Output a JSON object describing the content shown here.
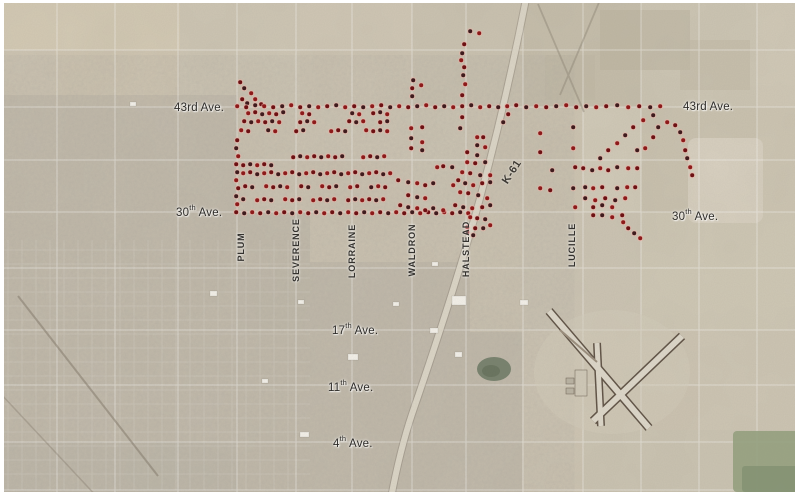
{
  "map_labels": {
    "avenues": [
      {
        "id": "43rd-left",
        "num": "43rd",
        "sup": "",
        "tail": " Ave."
      },
      {
        "id": "30th-left",
        "num": "30",
        "sup": "th",
        "tail": " Ave."
      },
      {
        "id": "43rd-right",
        "num": "43rd",
        "sup": "",
        "tail": " Ave."
      },
      {
        "id": "30th-right",
        "num": "30",
        "sup": "th",
        "tail": " Ave."
      },
      {
        "id": "17th",
        "num": "17",
        "sup": "th",
        "tail": " Ave."
      },
      {
        "id": "11th",
        "num": "11",
        "sup": "th",
        "tail": " Ave."
      },
      {
        "id": "4th",
        "num": "4",
        "sup": "th",
        "tail": " Ave."
      }
    ],
    "streets": [
      {
        "name": "PLUM"
      },
      {
        "name": "SEVERENCE"
      },
      {
        "name": "LORRAINE"
      },
      {
        "name": "WALDRON"
      },
      {
        "name": "HALSTEAD"
      },
      {
        "name": "LUCILLE"
      }
    ],
    "highway": {
      "name": "K-61"
    }
  },
  "dot_style": {
    "colors": [
      "#6d1113",
      "#3f1b1d",
      "#8d1a1a"
    ],
    "halo": "rgba(236,176,166,0.55)"
  },
  "dots": [
    [
      240,
      82
    ],
    [
      244,
      88
    ],
    [
      251,
      93
    ],
    [
      242,
      99
    ],
    [
      247,
      103
    ],
    [
      255,
      99
    ],
    [
      261,
      104
    ],
    [
      470,
      31
    ],
    [
      479,
      33
    ],
    [
      464,
      44
    ],
    [
      462,
      53
    ],
    [
      461,
      60
    ],
    [
      464,
      67
    ],
    [
      463,
      75
    ],
    [
      465,
      84
    ],
    [
      462,
      95
    ],
    [
      413,
      80
    ],
    [
      421,
      85
    ],
    [
      412,
      88
    ],
    [
      412,
      96
    ],
    [
      237,
      106
    ],
    [
      246,
      107
    ],
    [
      255,
      105
    ],
    [
      264,
      106
    ],
    [
      273,
      107
    ],
    [
      282,
      106
    ],
    [
      291,
      105
    ],
    [
      300,
      107
    ],
    [
      309,
      106
    ],
    [
      318,
      107
    ],
    [
      327,
      106
    ],
    [
      336,
      105
    ],
    [
      345,
      107
    ],
    [
      354,
      106
    ],
    [
      363,
      107
    ],
    [
      372,
      106
    ],
    [
      381,
      105
    ],
    [
      390,
      107
    ],
    [
      399,
      106
    ],
    [
      408,
      107
    ],
    [
      417,
      106
    ],
    [
      426,
      105
    ],
    [
      435,
      107
    ],
    [
      444,
      106
    ],
    [
      453,
      107
    ],
    [
      462,
      106
    ],
    [
      471,
      105
    ],
    [
      480,
      107
    ],
    [
      489,
      106
    ],
    [
      498,
      107
    ],
    [
      507,
      106
    ],
    [
      516,
      105
    ],
    [
      526,
      107
    ],
    [
      536,
      106
    ],
    [
      546,
      107
    ],
    [
      556,
      106
    ],
    [
      566,
      105
    ],
    [
      576,
      107
    ],
    [
      586,
      106
    ],
    [
      596,
      107
    ],
    [
      606,
      106
    ],
    [
      617,
      105
    ],
    [
      628,
      107
    ],
    [
      639,
      106
    ],
    [
      650,
      107
    ],
    [
      660,
      106
    ],
    [
      508,
      114
    ],
    [
      503,
      122
    ],
    [
      248,
      113
    ],
    [
      255,
      112
    ],
    [
      262,
      114
    ],
    [
      269,
      113
    ],
    [
      276,
      114
    ],
    [
      283,
      112
    ],
    [
      302,
      113
    ],
    [
      309,
      114
    ],
    [
      352,
      113
    ],
    [
      359,
      114
    ],
    [
      373,
      113
    ],
    [
      380,
      112
    ],
    [
      387,
      114
    ],
    [
      244,
      121
    ],
    [
      251,
      122
    ],
    [
      258,
      121
    ],
    [
      265,
      122
    ],
    [
      272,
      121
    ],
    [
      279,
      122
    ],
    [
      300,
      122
    ],
    [
      307,
      121
    ],
    [
      314,
      122
    ],
    [
      349,
      121
    ],
    [
      356,
      122
    ],
    [
      363,
      121
    ],
    [
      380,
      122
    ],
    [
      387,
      121
    ],
    [
      241,
      130
    ],
    [
      248,
      131
    ],
    [
      268,
      130
    ],
    [
      275,
      131
    ],
    [
      296,
      131
    ],
    [
      303,
      130
    ],
    [
      331,
      131
    ],
    [
      338,
      130
    ],
    [
      345,
      131
    ],
    [
      366,
      130
    ],
    [
      373,
      131
    ],
    [
      380,
      130
    ],
    [
      387,
      131
    ],
    [
      237,
      140
    ],
    [
      236,
      148
    ],
    [
      238,
      156
    ],
    [
      236,
      164
    ],
    [
      237,
      172
    ],
    [
      236,
      180
    ],
    [
      238,
      188
    ],
    [
      236,
      196
    ],
    [
      237,
      204
    ],
    [
      293,
      157
    ],
    [
      300,
      156
    ],
    [
      307,
      157
    ],
    [
      314,
      156
    ],
    [
      321,
      157
    ],
    [
      328,
      156
    ],
    [
      335,
      157
    ],
    [
      342,
      156
    ],
    [
      363,
      157
    ],
    [
      370,
      156
    ],
    [
      377,
      157
    ],
    [
      384,
      156
    ],
    [
      243,
      165
    ],
    [
      250,
      164
    ],
    [
      257,
      165
    ],
    [
      264,
      164
    ],
    [
      271,
      165
    ],
    [
      243,
      173
    ],
    [
      250,
      172
    ],
    [
      257,
      174
    ],
    [
      264,
      173
    ],
    [
      271,
      172
    ],
    [
      278,
      174
    ],
    [
      285,
      173
    ],
    [
      292,
      172
    ],
    [
      299,
      174
    ],
    [
      306,
      173
    ],
    [
      313,
      172
    ],
    [
      320,
      174
    ],
    [
      327,
      173
    ],
    [
      334,
      172
    ],
    [
      341,
      174
    ],
    [
      348,
      173
    ],
    [
      355,
      172
    ],
    [
      362,
      174
    ],
    [
      369,
      173
    ],
    [
      376,
      172
    ],
    [
      383,
      174
    ],
    [
      390,
      173
    ],
    [
      245,
      186
    ],
    [
      252,
      187
    ],
    [
      266,
      186
    ],
    [
      273,
      187
    ],
    [
      280,
      186
    ],
    [
      287,
      187
    ],
    [
      301,
      186
    ],
    [
      308,
      187
    ],
    [
      322,
      186
    ],
    [
      329,
      187
    ],
    [
      336,
      186
    ],
    [
      350,
      187
    ],
    [
      357,
      186
    ],
    [
      371,
      187
    ],
    [
      378,
      186
    ],
    [
      385,
      187
    ],
    [
      243,
      199
    ],
    [
      257,
      200
    ],
    [
      264,
      199
    ],
    [
      271,
      200
    ],
    [
      285,
      199
    ],
    [
      292,
      200
    ],
    [
      299,
      199
    ],
    [
      313,
      200
    ],
    [
      320,
      199
    ],
    [
      327,
      200
    ],
    [
      334,
      199
    ],
    [
      348,
      200
    ],
    [
      355,
      199
    ],
    [
      362,
      200
    ],
    [
      369,
      199
    ],
    [
      376,
      200
    ],
    [
      383,
      199
    ],
    [
      236,
      212
    ],
    [
      244,
      213
    ],
    [
      252,
      212
    ],
    [
      260,
      213
    ],
    [
      268,
      212
    ],
    [
      276,
      213
    ],
    [
      284,
      212
    ],
    [
      292,
      213
    ],
    [
      300,
      212
    ],
    [
      308,
      213
    ],
    [
      316,
      212
    ],
    [
      324,
      213
    ],
    [
      332,
      212
    ],
    [
      340,
      213
    ],
    [
      348,
      212
    ],
    [
      356,
      213
    ],
    [
      364,
      212
    ],
    [
      372,
      213
    ],
    [
      380,
      212
    ],
    [
      388,
      213
    ],
    [
      396,
      212
    ],
    [
      404,
      213
    ],
    [
      412,
      212
    ],
    [
      420,
      213
    ],
    [
      428,
      212
    ],
    [
      436,
      213
    ],
    [
      444,
      212
    ],
    [
      452,
      213
    ],
    [
      460,
      212
    ],
    [
      468,
      213
    ],
    [
      462,
      117
    ],
    [
      460,
      128
    ],
    [
      411,
      128
    ],
    [
      422,
      127
    ],
    [
      411,
      138
    ],
    [
      422,
      142
    ],
    [
      411,
      148
    ],
    [
      422,
      150
    ],
    [
      477,
      137
    ],
    [
      483,
      137
    ],
    [
      477,
      145
    ],
    [
      485,
      147
    ],
    [
      467,
      152
    ],
    [
      477,
      155
    ],
    [
      437,
      167
    ],
    [
      443,
      166
    ],
    [
      452,
      167
    ],
    [
      467,
      162
    ],
    [
      475,
      163
    ],
    [
      485,
      162
    ],
    [
      462,
      172
    ],
    [
      470,
      173
    ],
    [
      480,
      175
    ],
    [
      490,
      175
    ],
    [
      398,
      180
    ],
    [
      408,
      182
    ],
    [
      417,
      183
    ],
    [
      425,
      185
    ],
    [
      433,
      183
    ],
    [
      453,
      185
    ],
    [
      458,
      180
    ],
    [
      465,
      183
    ],
    [
      473,
      185
    ],
    [
      482,
      183
    ],
    [
      490,
      182
    ],
    [
      460,
      192
    ],
    [
      468,
      193
    ],
    [
      478,
      195
    ],
    [
      487,
      198
    ],
    [
      408,
      195
    ],
    [
      417,
      197
    ],
    [
      425,
      198
    ],
    [
      400,
      205
    ],
    [
      408,
      207
    ],
    [
      417,
      208
    ],
    [
      425,
      210
    ],
    [
      433,
      208
    ],
    [
      443,
      210
    ],
    [
      455,
      205
    ],
    [
      463,
      207
    ],
    [
      472,
      208
    ],
    [
      482,
      207
    ],
    [
      490,
      205
    ],
    [
      470,
      217
    ],
    [
      477,
      218
    ],
    [
      485,
      219
    ],
    [
      467,
      227
    ],
    [
      475,
      228
    ],
    [
      483,
      228
    ],
    [
      490,
      225
    ],
    [
      467,
      232
    ],
    [
      473,
      235
    ],
    [
      540,
      133
    ],
    [
      540,
      152
    ],
    [
      552,
      170
    ],
    [
      540,
      188
    ],
    [
      550,
      190
    ],
    [
      573,
      127
    ],
    [
      573,
      148
    ],
    [
      575,
      167
    ],
    [
      573,
      188
    ],
    [
      575,
      207
    ],
    [
      583,
      168
    ],
    [
      592,
      170
    ],
    [
      600,
      168
    ],
    [
      608,
      170
    ],
    [
      617,
      167
    ],
    [
      628,
      168
    ],
    [
      637,
      168
    ],
    [
      585,
      187
    ],
    [
      593,
      188
    ],
    [
      602,
      187
    ],
    [
      617,
      188
    ],
    [
      627,
      187
    ],
    [
      635,
      187
    ],
    [
      585,
      198
    ],
    [
      595,
      200
    ],
    [
      605,
      198
    ],
    [
      615,
      200
    ],
    [
      625,
      198
    ],
    [
      593,
      207
    ],
    [
      602,
      205
    ],
    [
      612,
      207
    ],
    [
      593,
      215
    ],
    [
      602,
      215
    ],
    [
      612,
      217
    ],
    [
      622,
      215
    ],
    [
      637,
      150
    ],
    [
      645,
      148
    ],
    [
      653,
      137
    ],
    [
      658,
      127
    ],
    [
      667,
      122
    ],
    [
      675,
      125
    ],
    [
      680,
      132
    ],
    [
      683,
      140
    ],
    [
      685,
      150
    ],
    [
      687,
      158
    ],
    [
      690,
      167
    ],
    [
      692,
      175
    ],
    [
      653,
      115
    ],
    [
      643,
      120
    ],
    [
      633,
      127
    ],
    [
      625,
      135
    ],
    [
      617,
      143
    ],
    [
      608,
      150
    ],
    [
      600,
      158
    ],
    [
      623,
      222
    ],
    [
      628,
      228
    ],
    [
      634,
      233
    ],
    [
      640,
      238
    ]
  ]
}
